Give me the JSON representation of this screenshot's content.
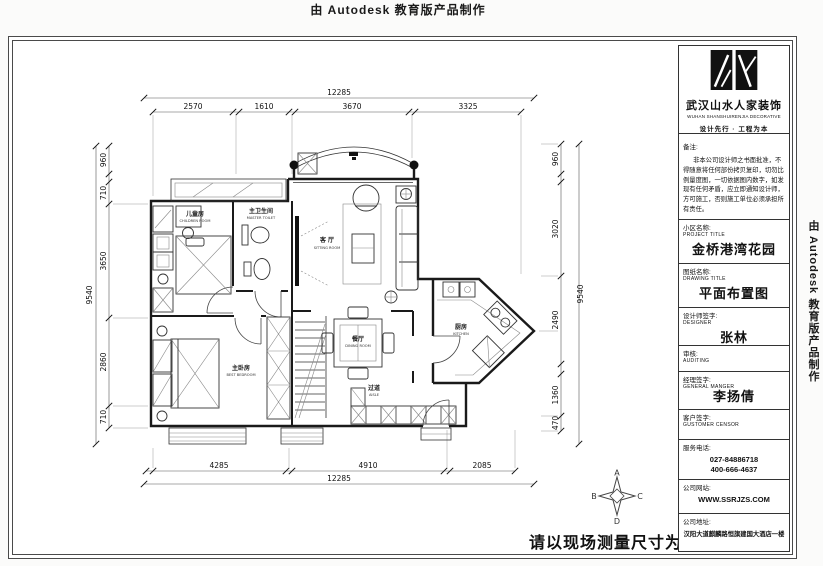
{
  "page": {
    "top_stamp": "由 Autodesk 教育版产品制作",
    "right_stamp": "由 Autodesk 教育版产品制作",
    "bottom_note": "请以现场测量尺寸为准",
    "line_color": "#1a1a1a",
    "paper_color": "#ffffff"
  },
  "title_block": {
    "company": {
      "name": "武汉山水人家装饰",
      "name_en": "WUHAN SHANSHUIRENJIA DECORATIVE",
      "slogan": "设计先行 · 工程为本"
    },
    "remarks": {
      "label": "备注:",
      "text": "非本公司设计师之书面批准，不得随意将任何部份拷贝复印，切勿比例量度图，一切依据图内数字，如发现有任何矛盾，应立即通知设计师，方可施工，否则施工单位必须承担所有责任。"
    },
    "project": {
      "label": "小区名称:",
      "label_en": "PROJECT TITLE",
      "value": "金桥港湾花园"
    },
    "drawing": {
      "label": "图纸名称:",
      "label_en": "DRAWING TITLE",
      "value": "平面布置图"
    },
    "designer": {
      "label": "设计师签字:",
      "label_en": "DESIGNER",
      "value": "张林"
    },
    "auditing": {
      "label": "审核:",
      "label_en": "AUDITING"
    },
    "manager": {
      "label": "经理签字:",
      "label_en": "GENERAL MANGER",
      "value": "李扬倩"
    },
    "customer": {
      "label": "客户签字:",
      "label_en": "GUSTOMER CENSOR"
    },
    "phone": {
      "label": "服务电话:",
      "line1": "027-84886718",
      "line2": "400-666-4637"
    },
    "website": {
      "label": "公司网站:",
      "value": "WWW.SSRJZS.COM"
    },
    "address": {
      "label": "公司地址:",
      "value": "汉阳大道麒麟路恒旗建国大酒店一楼"
    }
  },
  "plan": {
    "dims": {
      "top": {
        "total": "12285",
        "segments": [
          "2570",
          "1610",
          "3670",
          "3325"
        ]
      },
      "bottom": {
        "total": "12285",
        "segments": [
          "4285",
          "4910",
          "2085"
        ]
      },
      "left": {
        "total": "9540",
        "segments": [
          "960",
          "710",
          "3650",
          "2860",
          "710"
        ]
      },
      "right": {
        "total": "9540",
        "segments": [
          "960",
          "3020",
          "2490",
          "1360",
          "470"
        ]
      }
    },
    "rooms": {
      "children": {
        "cn": "儿童房",
        "en": "CHILDREN ROOM"
      },
      "bath": {
        "cn": "主卫生间",
        "en": "MASTER TOILET"
      },
      "living": {
        "cn": "客 厅",
        "en": "SITTING ROOM"
      },
      "dining": {
        "cn": "餐厅",
        "en": "DINING ROOM"
      },
      "kitchen": {
        "cn": "厨房",
        "en": "KITCHEN"
      },
      "master": {
        "cn": "主卧房",
        "en": "BEST BEDROOM"
      },
      "aisle": {
        "cn": "过道",
        "en": "AISLE"
      }
    },
    "compass": {
      "n": "A",
      "w": "B",
      "e": "C",
      "s": "D"
    }
  }
}
